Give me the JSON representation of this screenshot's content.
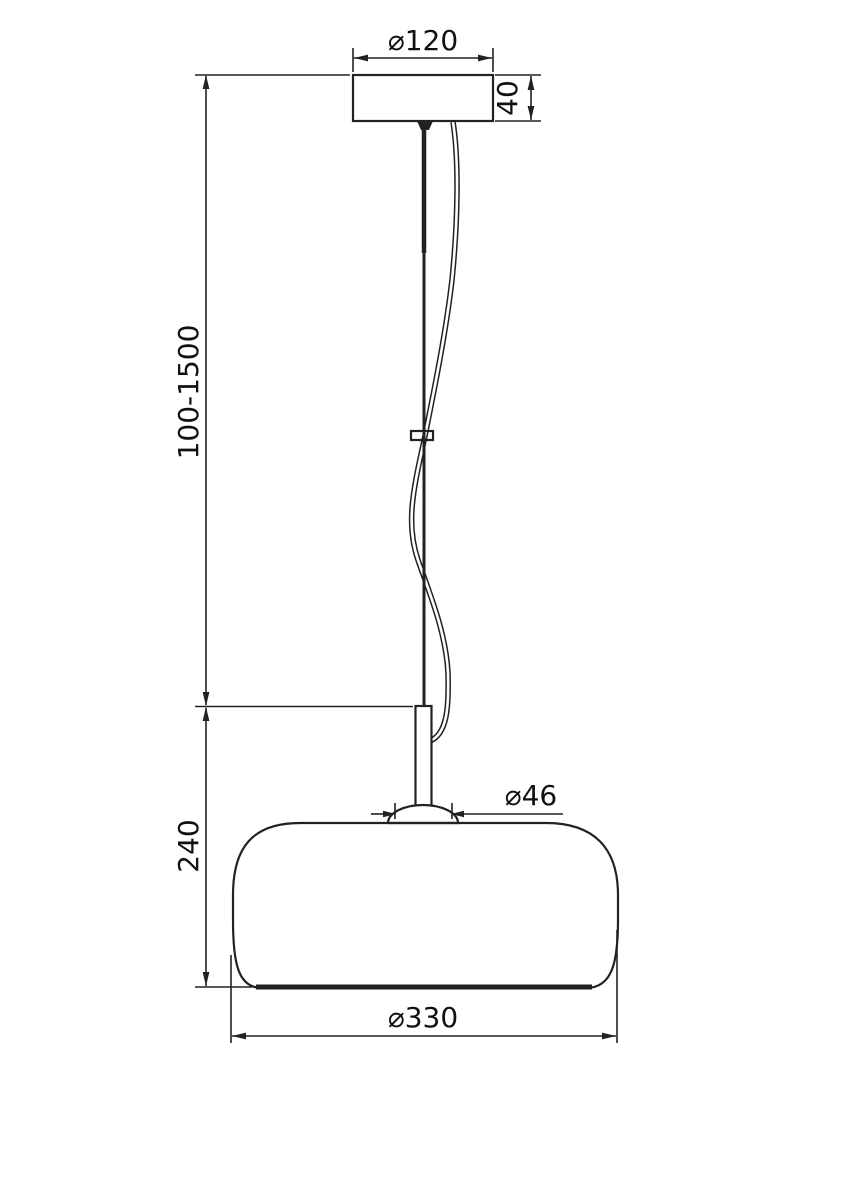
{
  "colors": {
    "background": "#ffffff",
    "line": "#222222",
    "text": "#111111"
  },
  "dimensions": {
    "canopy_diameter": "⌀120",
    "canopy_height": "40",
    "suspension_length": "100-1500",
    "shade_height": "240",
    "stem_base_diameter": "⌀46",
    "shade_diameter": "⌀330"
  }
}
